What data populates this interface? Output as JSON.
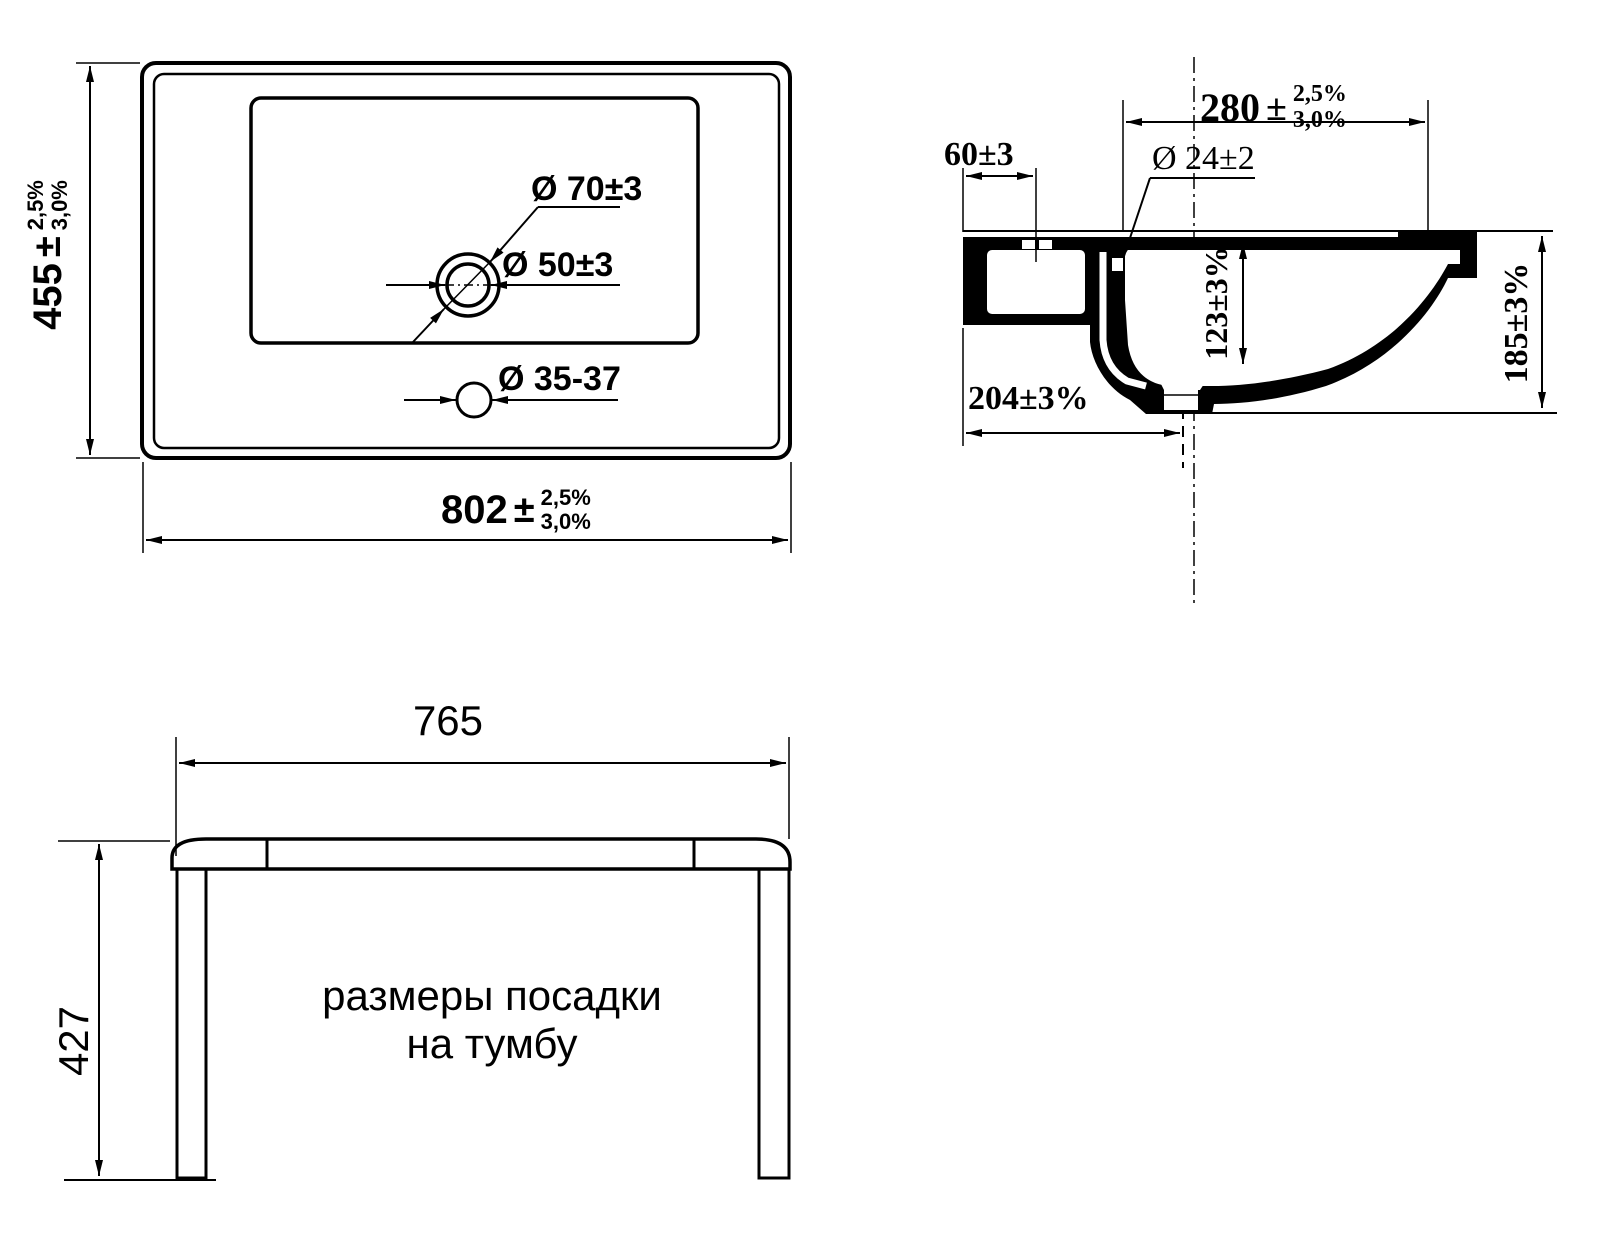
{
  "views": {
    "top": {
      "title": "top-view",
      "width_dim": {
        "value": "802",
        "pm": "±",
        "tol_upper": "2,5%",
        "tol_lower": "3,0%"
      },
      "height_dim": {
        "value": "455",
        "pm": "±",
        "tol_upper": "2,5%",
        "tol_lower": "3,0%"
      },
      "faucet_hole_outer_label": "Ø 70±3",
      "faucet_hole_inner_label": "Ø 50±3",
      "overflow_hole_label": "Ø 35-37"
    },
    "side": {
      "title": "side-section-view",
      "bowl_offset_dim": {
        "value": "280",
        "pm": "±",
        "tol_upper": "2,5%",
        "tol_lower": "3,0%"
      },
      "back_ledge_label": "60±3",
      "overflow_hole_label": "Ø 24±2",
      "bowl_depth_label": "123±3%",
      "overall_height_label": "185±3%",
      "drain_offset_label": "204±3%"
    },
    "front": {
      "title": "cabinet-mount-view",
      "mount_width_label": "765",
      "mount_height_label": "427",
      "caption_line1": "размеры посадки",
      "caption_line2": "на тумбу"
    }
  },
  "colors": {
    "line": "#000000",
    "background": "#ffffff"
  }
}
